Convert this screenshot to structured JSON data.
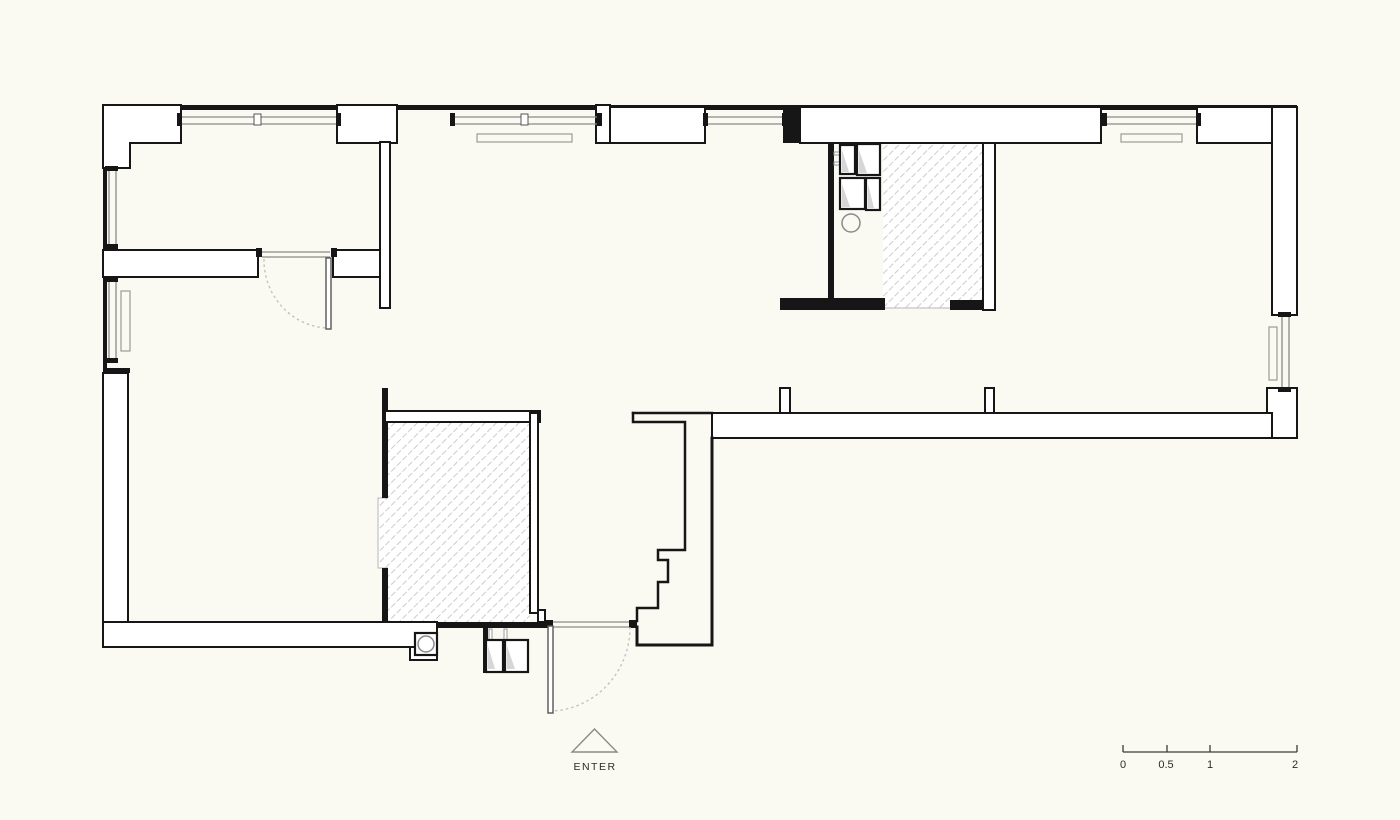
{
  "canvas": {
    "width": 1400,
    "height": 820,
    "background": "#fafaf2"
  },
  "plan": {
    "type": "apartment-floor-plan",
    "entry_label": "ENTER",
    "areas": {
      "hatched_room_top": "bathroom-hatched-floor",
      "hatched_room_bottom": "closet-hatched-floor"
    },
    "symbols": [
      "entry-direction-triangle",
      "door-swing-arcs",
      "window-glazing-lines",
      "radiators",
      "laundry-appliances",
      "boiler-with-circle"
    ]
  },
  "scale_bar": {
    "tick_labels": [
      "0",
      "0.5",
      "1",
      "2"
    ]
  },
  "colors": {
    "wall": "#161616",
    "window_line": "#8a8a8a",
    "hatch_line": "#cccccc",
    "dash_arc": "#c2c2c2",
    "text": "#2b2b2b",
    "background": "#fafaf2"
  }
}
